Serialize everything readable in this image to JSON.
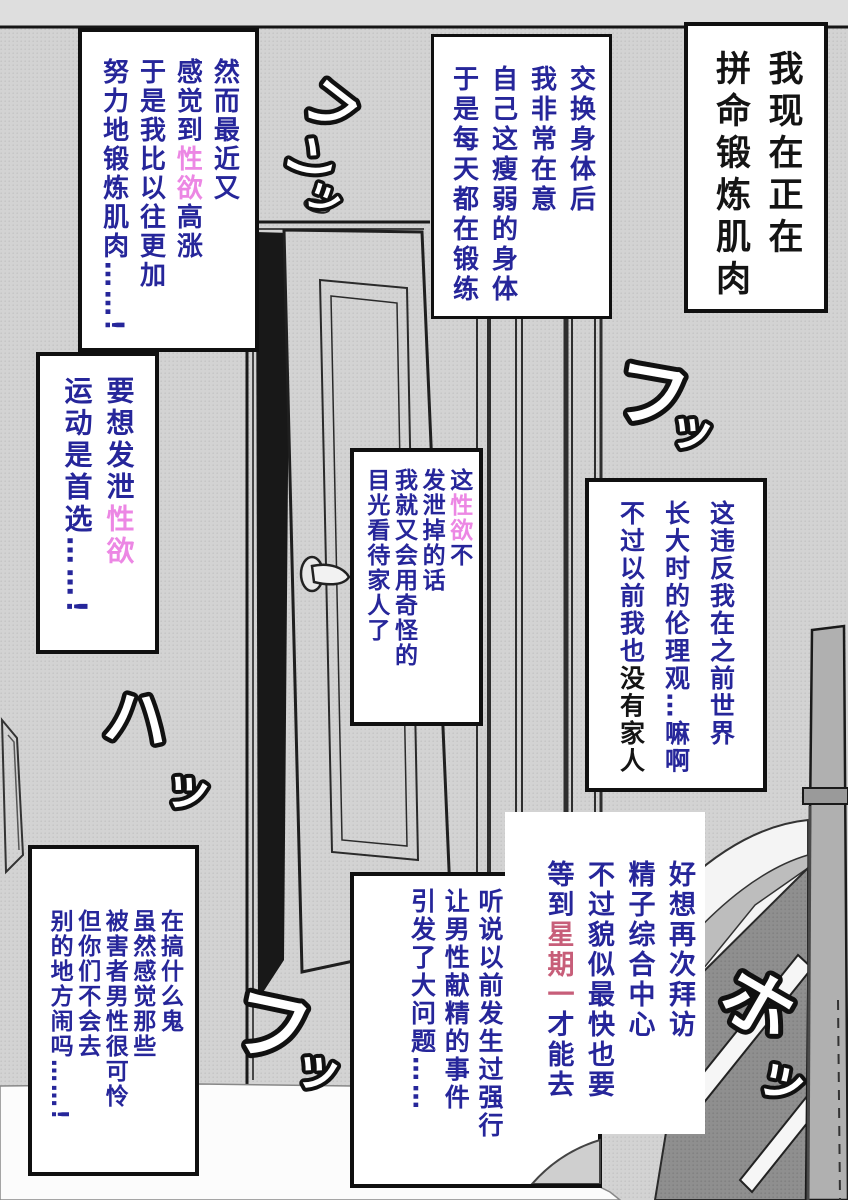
{
  "colors": {
    "navy": "#26269a",
    "pink": "#ec87e4",
    "rose": "#c75e79",
    "dark": "#141414",
    "wall": "#d3d3d3"
  },
  "boxes": {
    "title": {
      "cols": [
        [
          {
            "t": "我现在正在"
          }
        ],
        [
          {
            "t": "拼命锻炼肌肉"
          }
        ]
      ]
    },
    "train": {
      "cols": [
        [
          {
            "t": "交换身体后"
          }
        ],
        [
          {
            "t": "我非常在意"
          }
        ],
        [
          {
            "t": "自己这瘦弱的身体"
          }
        ],
        [
          {
            "t": "于是每天都在锻练"
          }
        ]
      ]
    },
    "however": {
      "cols": [
        [
          {
            "t": "然而最近又"
          }
        ],
        [
          {
            "t": "感觉到"
          },
          {
            "t": "性欲",
            "c": "pink"
          },
          {
            "t": "高涨"
          }
        ],
        [
          {
            "t": "于是我比以往更加"
          }
        ],
        [
          {
            "t": "努力地锻炼肌肉……!"
          }
        ]
      ]
    },
    "vent": {
      "cols": [
        [
          {
            "t": "要想发泄"
          },
          {
            "t": "性欲",
            "c": "pink"
          }
        ],
        [
          {
            "t": "运动是首选……!"
          }
        ]
      ]
    },
    "gaze": {
      "cols": [
        [
          {
            "t": "这"
          },
          {
            "t": "性欲",
            "c": "pink"
          },
          {
            "t": "不"
          }
        ],
        [
          {
            "t": "发泄掉的话"
          }
        ],
        [
          {
            "t": "我就又会用奇怪的"
          }
        ],
        [
          {
            "t": "目光看待家人了"
          }
        ]
      ]
    },
    "ethics": {
      "cols": [
        [
          {
            "t": "这违反我在之前世界"
          }
        ],
        [
          {
            "t": "长大时的伦理观…嘛啊"
          }
        ],
        [
          {
            "t": "不过以前我也"
          },
          {
            "t": "没有家人",
            "c": "dark"
          }
        ]
      ]
    },
    "visit": {
      "cols": [
        [
          {
            "t": "好想再次拜访"
          }
        ],
        [
          {
            "t": "精子综合中心"
          }
        ],
        [
          {
            "t": "不过貌似最快也要"
          }
        ],
        [
          {
            "t": "等到"
          },
          {
            "t": "星期一",
            "c": "rose"
          },
          {
            "t": "才能去"
          }
        ]
      ]
    },
    "incident": {
      "cols": [
        [
          {
            "t": "听说以前发生过强行"
          }
        ],
        [
          {
            "t": "让男性献精的事件"
          }
        ],
        [
          {
            "t": "引发了大问题……"
          }
        ]
      ]
    },
    "complain": {
      "cols": [
        [
          {
            "t": "在搞什么鬼"
          }
        ],
        [
          {
            "t": "虽然感觉那些"
          }
        ],
        [
          {
            "t": "被害者男性很可怜"
          }
        ],
        [
          {
            "t": "但你们不会去"
          }
        ],
        [
          {
            "t": "别的地方闹吗……!"
          }
        ]
      ]
    }
  },
  "sfx": [
    {
      "name": "funn",
      "chars": [
        "フ",
        "ン",
        "ッ"
      ]
    },
    {
      "name": "fu-upper",
      "chars": [
        "フ",
        "ッ"
      ]
    },
    {
      "name": "ha",
      "chars": [
        "ハ",
        "ッ"
      ]
    },
    {
      "name": "fu-lower",
      "chars": [
        "フ",
        "ッ"
      ]
    },
    {
      "name": "ho",
      "chars": [
        "ホ",
        "ッ"
      ]
    }
  ]
}
